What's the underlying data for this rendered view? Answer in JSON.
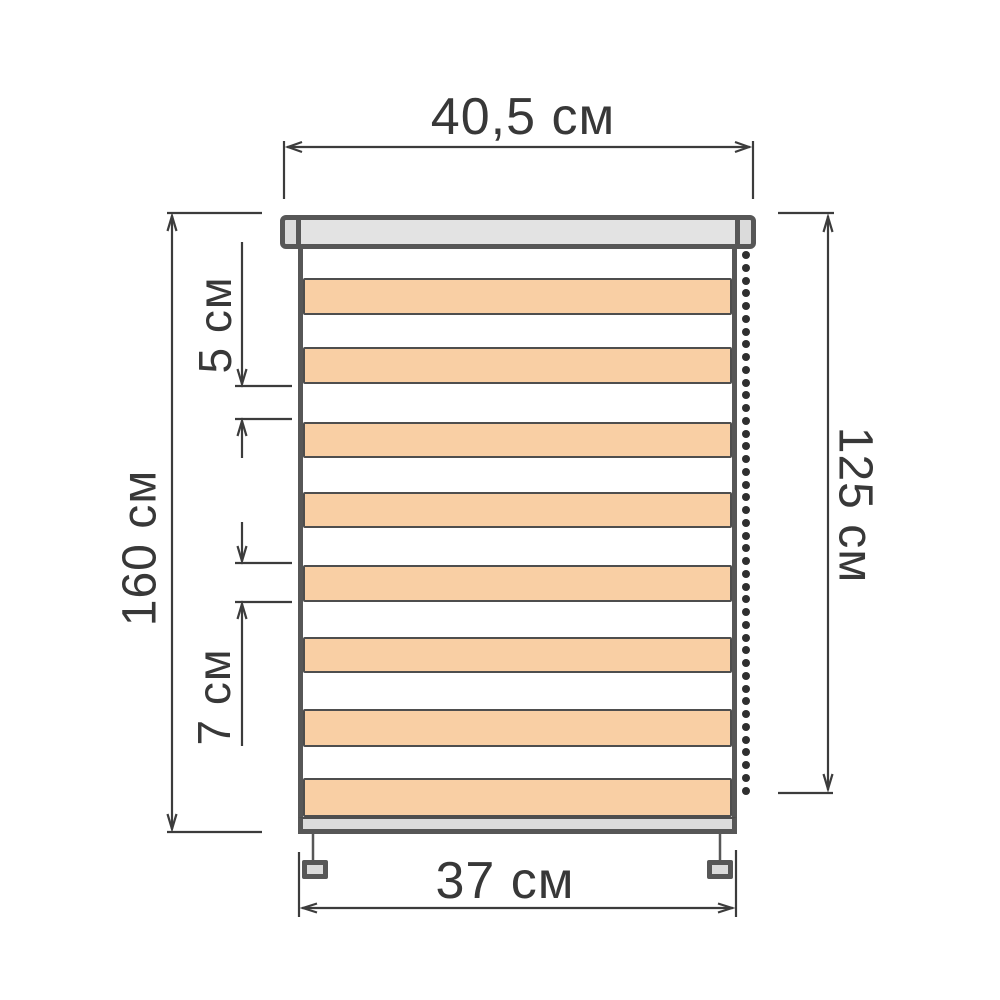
{
  "labels": {
    "top_width": "40,5 см",
    "fabric_width": "37 см",
    "total_height": "160 см",
    "chain_length": "125 см",
    "open_stripe_height": "5 см",
    "solid_stripe_height": "7 см"
  },
  "colors": {
    "outline": "#575757",
    "stripe_border": "#4e4e4e",
    "stripe_fill": "#F9CFA4",
    "cassette_fill": "#E3E3E3",
    "cap_fill": "#DBDBDB",
    "bottom_bar_fill": "#DCDCDC",
    "dimension_line": "#3C3C3C",
    "text": "#383838",
    "chain_bead": "#2F2F2F"
  },
  "blind": {
    "stripes": [
      {
        "top": 29,
        "height": 37
      },
      {
        "top": 98,
        "height": 37
      },
      {
        "top": 173,
        "height": 36
      },
      {
        "top": 243,
        "height": 36
      },
      {
        "top": 316,
        "height": 37
      },
      {
        "top": 388,
        "height": 36
      },
      {
        "top": 460,
        "height": 38
      },
      {
        "top": 529,
        "height": 39
      }
    ],
    "chain": {
      "bead_count": 43,
      "bead_diameter": 8,
      "spacing": 12.75,
      "start_y": 255,
      "x": 746
    }
  }
}
